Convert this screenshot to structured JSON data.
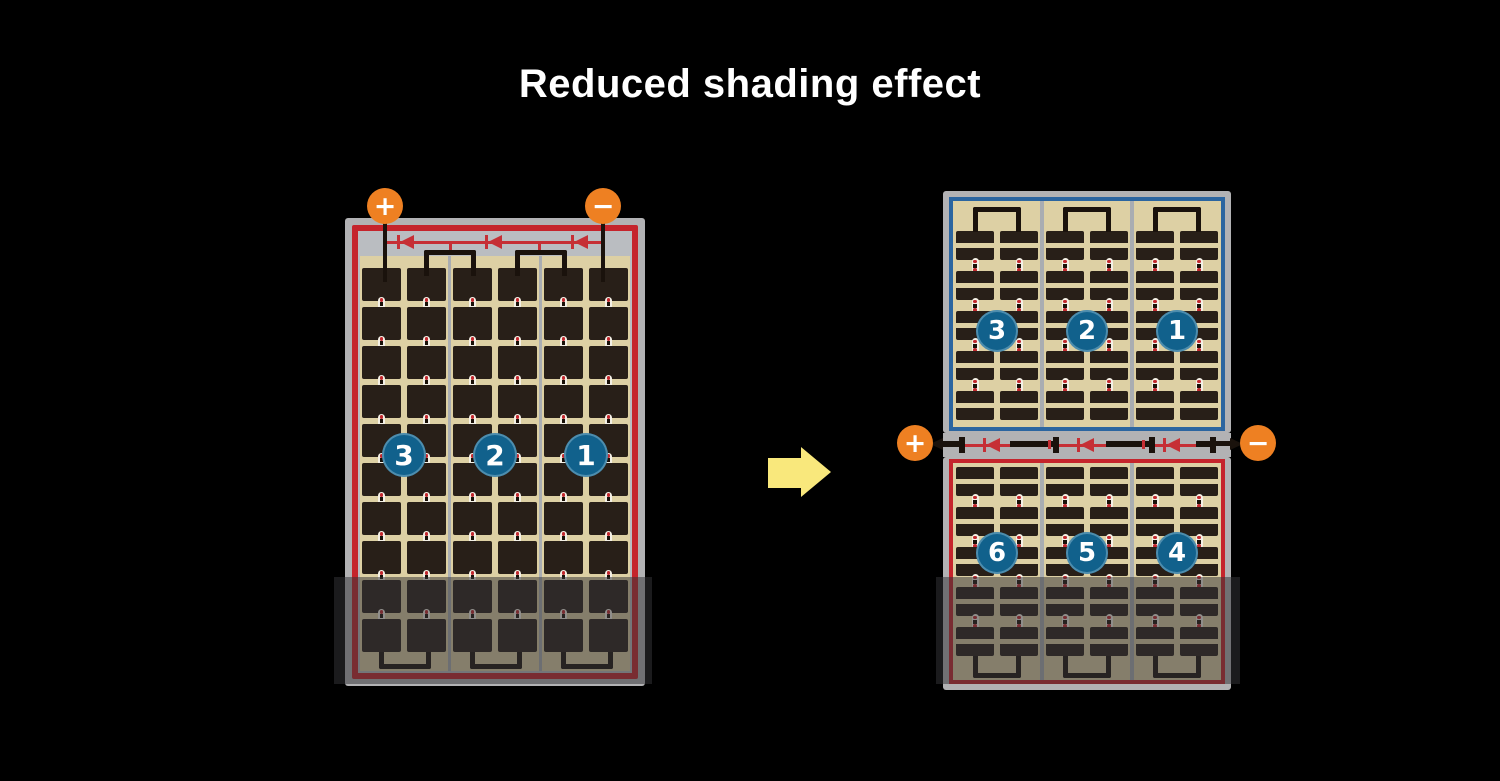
{
  "title": "Reduced shading effect",
  "colors": {
    "background": "#000000",
    "frame_gray": "#b2b2b4",
    "cell_tan": "#ddd0a4",
    "cell_dark": "#281f18",
    "accent_red": "#c5242c",
    "accent_blue": "#2b65a0",
    "badge_blue": "#11618c",
    "terminal_orange": "#ee8022",
    "arrow_yellow": "#f9e87c"
  },
  "left_panel": {
    "terminals": [
      {
        "symbol": "+"
      },
      {
        "symbol": "−"
      }
    ],
    "strings": [
      {
        "number": "3"
      },
      {
        "number": "2"
      },
      {
        "number": "1"
      }
    ]
  },
  "right_panel": {
    "terminals": [
      {
        "symbol": "+"
      },
      {
        "symbol": "−"
      }
    ],
    "top_strings": [
      {
        "number": "3"
      },
      {
        "number": "2"
      },
      {
        "number": "1"
      }
    ],
    "bottom_strings": [
      {
        "number": "6"
      },
      {
        "number": "5"
      },
      {
        "number": "4"
      }
    ]
  }
}
